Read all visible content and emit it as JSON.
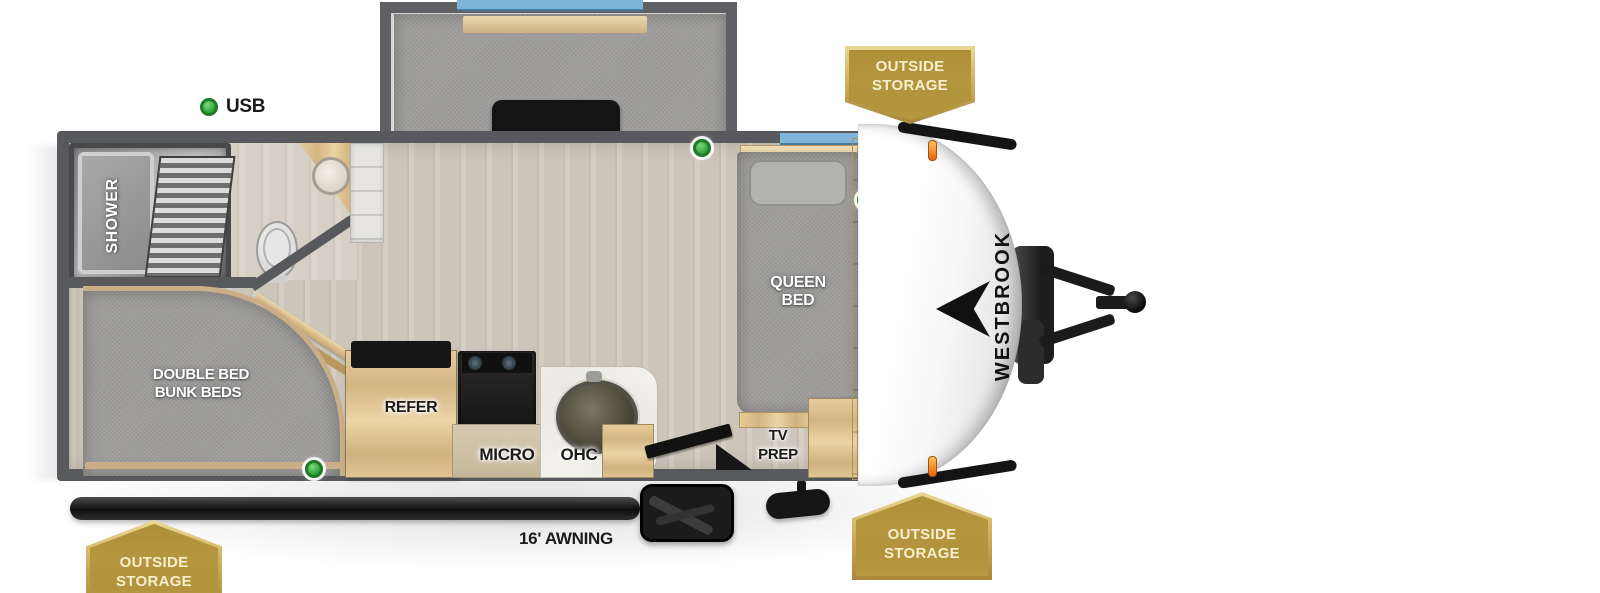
{
  "page": {
    "description": "Travel trailer floor plan, top-down view"
  },
  "brand": {
    "name": "WESTBROOK"
  },
  "legend": {
    "usb": "USB"
  },
  "labels": {
    "dinette": "DINETTE",
    "shower": "SHOWER",
    "queen1": "QUEEN",
    "queen2": "BED",
    "bunk1": "DOUBLE BED",
    "bunk2": "BUNK BEDS",
    "refer": "REFER",
    "micro": "MICRO",
    "ohc_kitchen": "OHC",
    "ohc_wardrobe": "OHC",
    "tv1": "TV",
    "tv2": "PREP",
    "awning": "16' AWNING"
  },
  "badges": {
    "top": {
      "line1": "OUTSIDE",
      "line2": "STORAGE"
    },
    "bottom_right": {
      "line1": "OUTSIDE",
      "line2": "STORAGE"
    },
    "bottom_left": {
      "line1": "OUTSIDE",
      "line2": "STORAGE"
    }
  },
  "colors": {
    "badge_gold": "#b6983f",
    "usb_green": "#3fae49",
    "window_blue": "#7db6d9",
    "wall_gray": "#58595c",
    "floor": "#d2cbc0",
    "wood": "#ddbf8e"
  }
}
